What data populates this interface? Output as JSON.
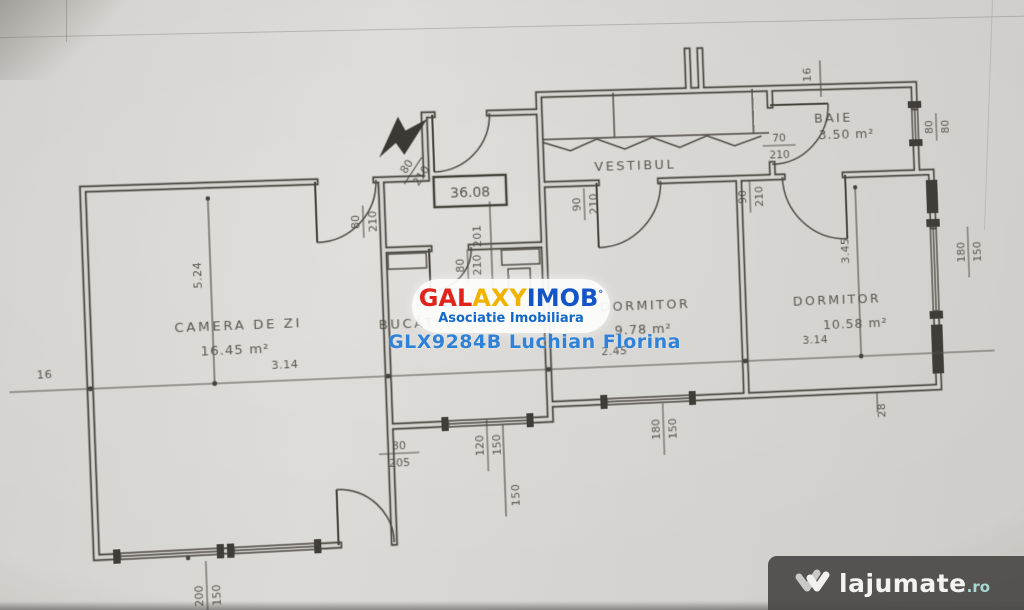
{
  "rooms": {
    "living": {
      "name": "CAMERA DE ZI",
      "area": "16.45 m²"
    },
    "kitchen": {
      "name": "BUCĂT."
    },
    "vestibule": {
      "name": "VESTIBUL"
    },
    "bath": {
      "name": "BAIE",
      "area": "3.50 m²"
    },
    "bedroom1": {
      "name": "DORMITOR",
      "area": "9.78 m²"
    },
    "bedroom2": {
      "name": "DORMITOR",
      "area": "10.58 m²"
    }
  },
  "total_area": "36.08",
  "dims": {
    "living_h": "5.24",
    "living_w": "3.14",
    "wall_left": "16",
    "wall_top": "16",
    "bed1_w": "2.45",
    "bed2_w": "3.14",
    "bed2_h": "3.45",
    "corridor": "201",
    "right_offset": "28",
    "sill": "150"
  },
  "fractions": {
    "entrance": {
      "num": "80",
      "den": "210"
    },
    "living_door": {
      "num": "80",
      "den": "210"
    },
    "kitchen_door": {
      "num": "80",
      "den": "210"
    },
    "bed1_door": {
      "num": "90",
      "den": "210"
    },
    "bed2_door": {
      "num": "90",
      "den": "210"
    },
    "bath_door": {
      "num": "70",
      "den": "210"
    },
    "bath_window": {
      "num": "80",
      "den": "80"
    },
    "bed2_window": {
      "num": "180",
      "den": "150"
    },
    "bed1_window": {
      "num": "180",
      "den": "150"
    },
    "kitchen_window": {
      "num": "120",
      "den": "150"
    },
    "balcony_door": {
      "num": "80",
      "den": "205"
    },
    "living_window": {
      "num": "200",
      "den": "150"
    }
  },
  "watermark": {
    "brand_gal": "GAL",
    "brand_axy": "AXY",
    "brand_imob": "IMOB",
    "brand_mark": "°",
    "subtitle": "Asociatie Imobiliara",
    "agent": "GLX9284B Luchian Florina",
    "color_red": "#e2231c",
    "color_yellow": "#f2b300",
    "color_blue": "#1354c8"
  },
  "footer": {
    "site": "lajumate",
    "tld": ".ro",
    "tld_color": "#a9d8d3"
  }
}
